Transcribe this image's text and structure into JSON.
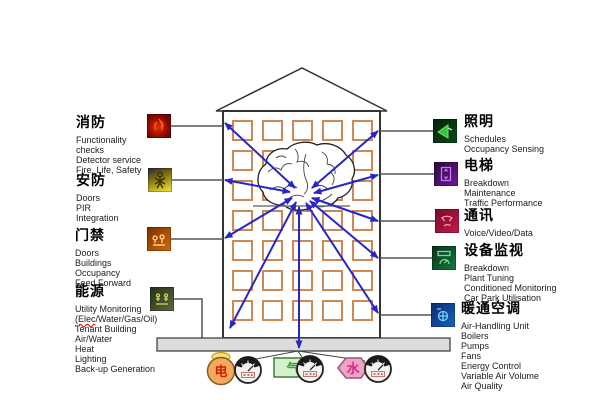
{
  "diagram": {
    "title_implicit": "",
    "left_sections": [
      {
        "heading": "消防",
        "icon": "fire-icon",
        "lines": [
          "Functionality",
          "checks",
          "Detector service",
          "Fire, Life, Safety"
        ]
      },
      {
        "heading": "安防",
        "icon": "security-person-icon",
        "lines": [
          "Doors",
          "PIR",
          "Integration"
        ]
      },
      {
        "heading": "门禁",
        "icon": "access-control-icon",
        "lines": [
          "Doors",
          "Buildings",
          "Occupancy",
          "Feed Forward"
        ]
      },
      {
        "heading": "能源",
        "icon": "energy-icon",
        "lines": [
          "Utility Monitoring",
          "Tenant Building",
          "Air/Water",
          "Heat",
          "Lighting",
          "Back-up Generation"
        ],
        "elec_line": {
          "marked": "(Elec",
          "rest": "/Water/Gas/Oil)"
        }
      }
    ],
    "right_sections": [
      {
        "heading": "照明",
        "icon": "lighting-icon",
        "lines": [
          "Schedules",
          "Occupancy Sensing"
        ]
      },
      {
        "heading": "电梯",
        "icon": "elevator-icon",
        "lines": [
          "Breakdown",
          "Maintenance",
          "Traffic Performance"
        ]
      },
      {
        "heading": "通讯",
        "icon": "communications-icon",
        "lines": [
          "Voice/Video/Data"
        ]
      },
      {
        "heading": "设备监视",
        "icon": "equipment-monitor-icon",
        "lines": [
          "Breakdown",
          "Plant Tuning",
          "Conditioned Monitoring",
          "Car Park Utilisation"
        ]
      },
      {
        "heading": "暖通空调",
        "icon": "hvac-icon",
        "lines": [
          "Air-Handling Unit",
          "Boilers",
          "Pumps",
          "Fans",
          "Energy Control",
          "Variable Air Volume",
          "Air Quality"
        ]
      }
    ],
    "utilities": [
      {
        "label": "电",
        "shape": "circle",
        "color": "#f3aa5e",
        "text_color": "#cc2200"
      },
      {
        "label": "气",
        "shape": "rectangle",
        "color": "#d4f0cc",
        "text_color": "#3f9d3f"
      },
      {
        "label": "水",
        "shape": "hexagon",
        "color": "#f0a3c3",
        "text_color": "#d12a8a"
      }
    ],
    "colors": {
      "arrow_blue": "#2626c9",
      "window_frame": "#cc8855",
      "building_outline": "#333333",
      "base_bar_fill": "#dcdcdc",
      "connector": "#555555"
    }
  }
}
